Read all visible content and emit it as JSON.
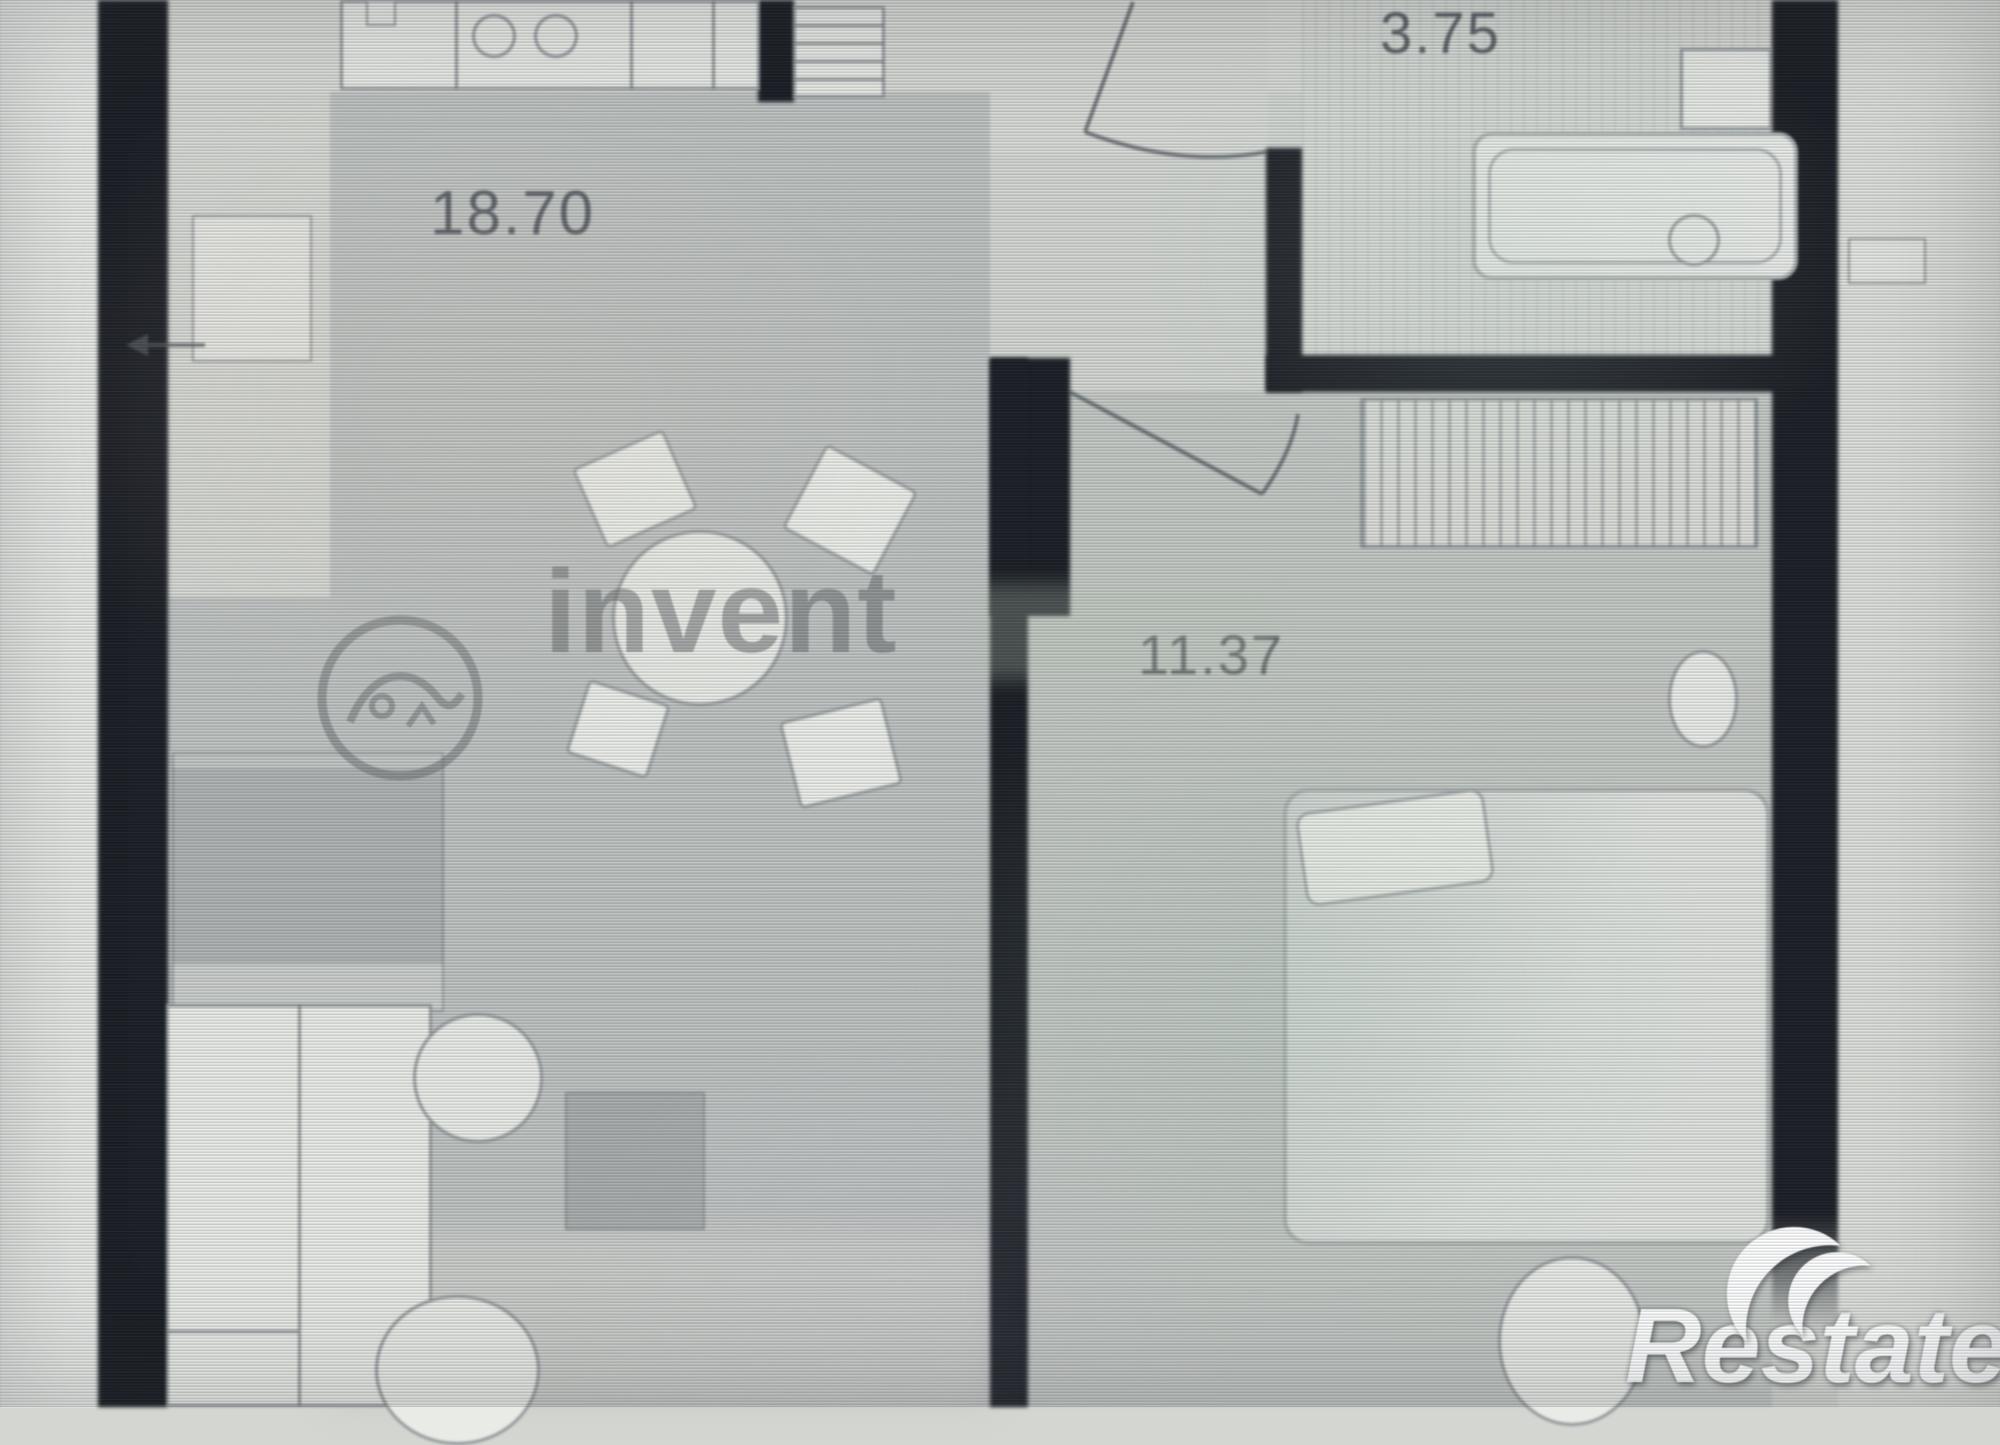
{
  "plan": {
    "type": "apartment-floor-plan-photo",
    "rooms": [
      {
        "name": "living-kitchen",
        "area": "18.70"
      },
      {
        "name": "bathroom",
        "area": "3.75"
      },
      {
        "name": "bedroom",
        "area": "11.37"
      }
    ]
  },
  "watermark": {
    "text": "invent",
    "logo_icon": "invent-circle-logo"
  },
  "branding": {
    "text": "Restate",
    "logo_icon": "double-crescent-icon"
  },
  "icons": [
    "stove-burners-icon",
    "fridge-shelves-icon",
    "dining-table-icon",
    "chair-icon",
    "sofa-icon",
    "wardrobe-icon",
    "armchair-icon",
    "coffee-table-icon",
    "bed-icon",
    "pillow-icon",
    "nightstand-icon",
    "pouf-icon",
    "hatched-wardrobe-icon",
    "bathtub-icon",
    "faucet-icon",
    "sink-icon",
    "towel-rail-icon",
    "door-swing-icon",
    "entrance-arrow-icon",
    "invent-circle-logo",
    "double-crescent-icon"
  ],
  "colors": {
    "wall": "#171a20",
    "floor_light": "#d6d8d3",
    "floor_gray": "#bec2c0",
    "label_text": "#474b52",
    "watermark_gray": "#666a6c",
    "branding_white": "#ffffff"
  }
}
